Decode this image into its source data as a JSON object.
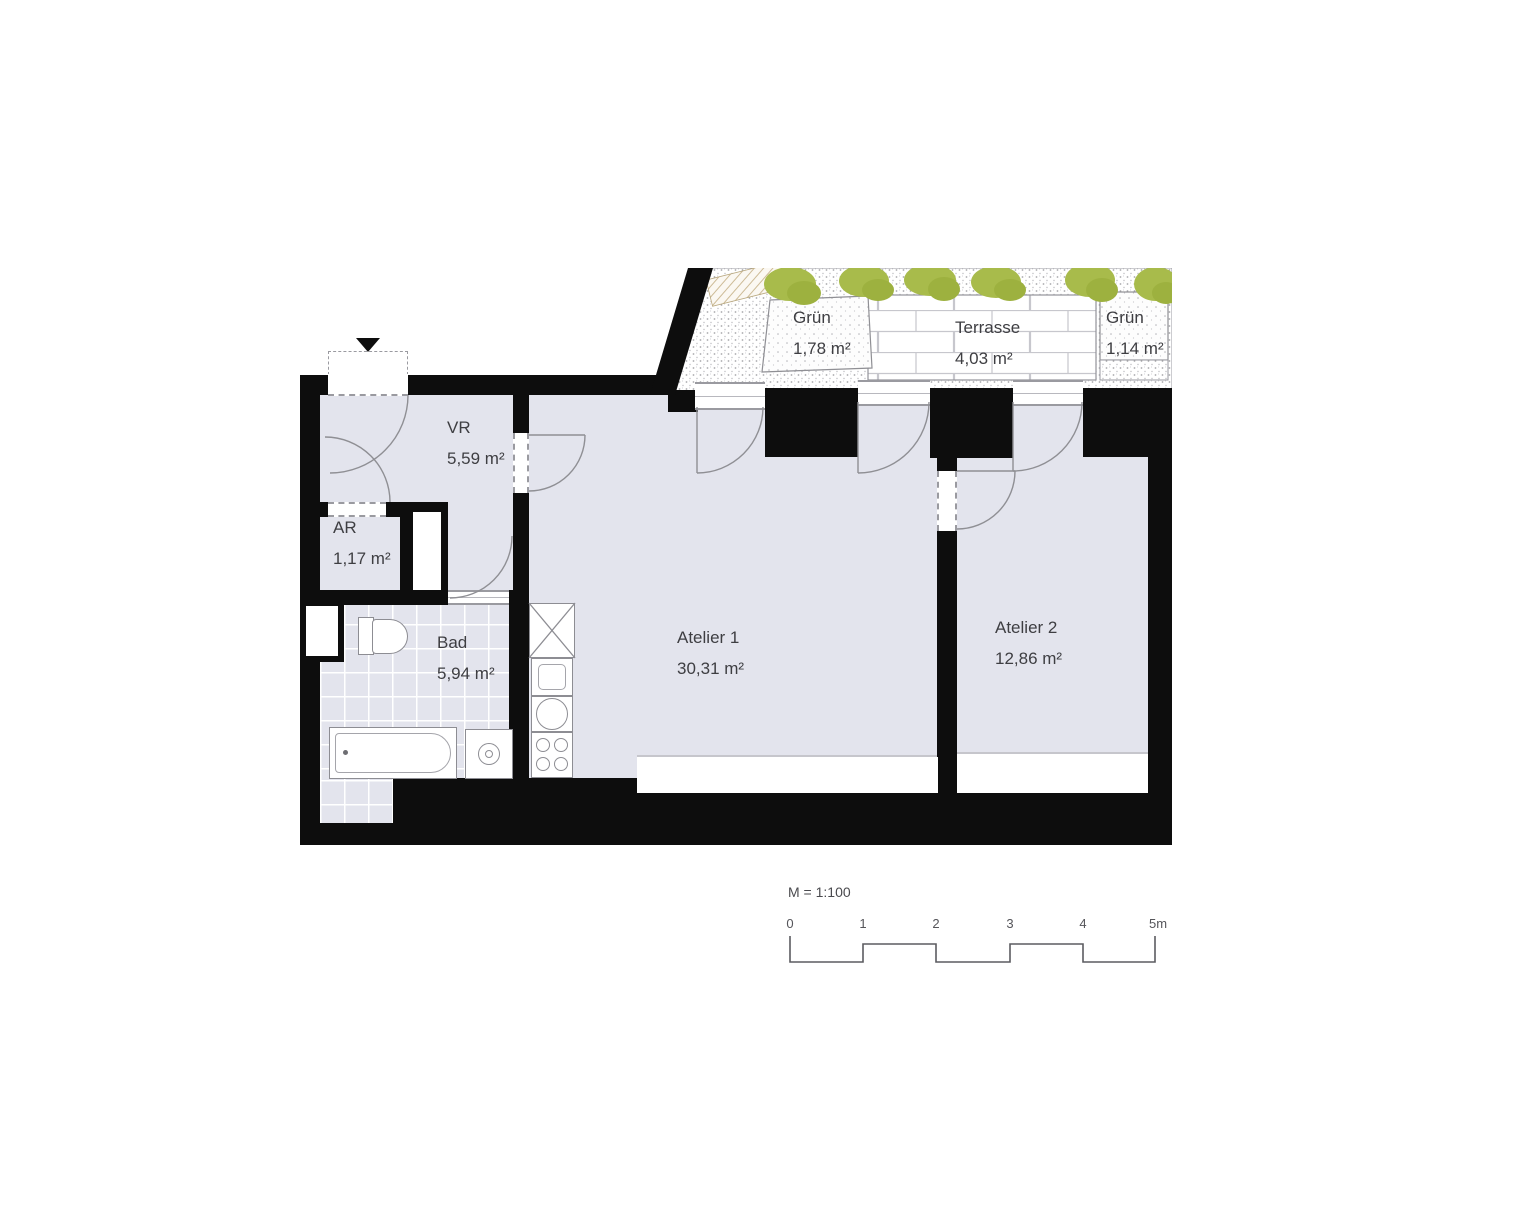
{
  "plan": {
    "rooms": [
      {
        "name": "VR",
        "area": "5,59 m²"
      },
      {
        "name": "AR",
        "area": "1,17 m²"
      },
      {
        "name": "Bad",
        "area": "5,94 m²"
      },
      {
        "name": "Atelier 1",
        "area": "30,31 m²"
      },
      {
        "name": "Atelier 2",
        "area": "12,86 m²"
      }
    ],
    "outdoor": [
      {
        "name": "Grün",
        "area": "1,78 m²"
      },
      {
        "name": "Terrasse",
        "area": "4,03 m²"
      },
      {
        "name": "Grün",
        "area": "1,14 m²"
      }
    ],
    "scale": {
      "label": "M = 1:100",
      "ticks": [
        "0",
        "1",
        "2",
        "3",
        "4",
        "5m"
      ]
    },
    "colors": {
      "wall": "#0d0d0d",
      "floor": "#e3e4ed",
      "green": "#a8bb4b",
      "line": "#8f8f94"
    }
  }
}
